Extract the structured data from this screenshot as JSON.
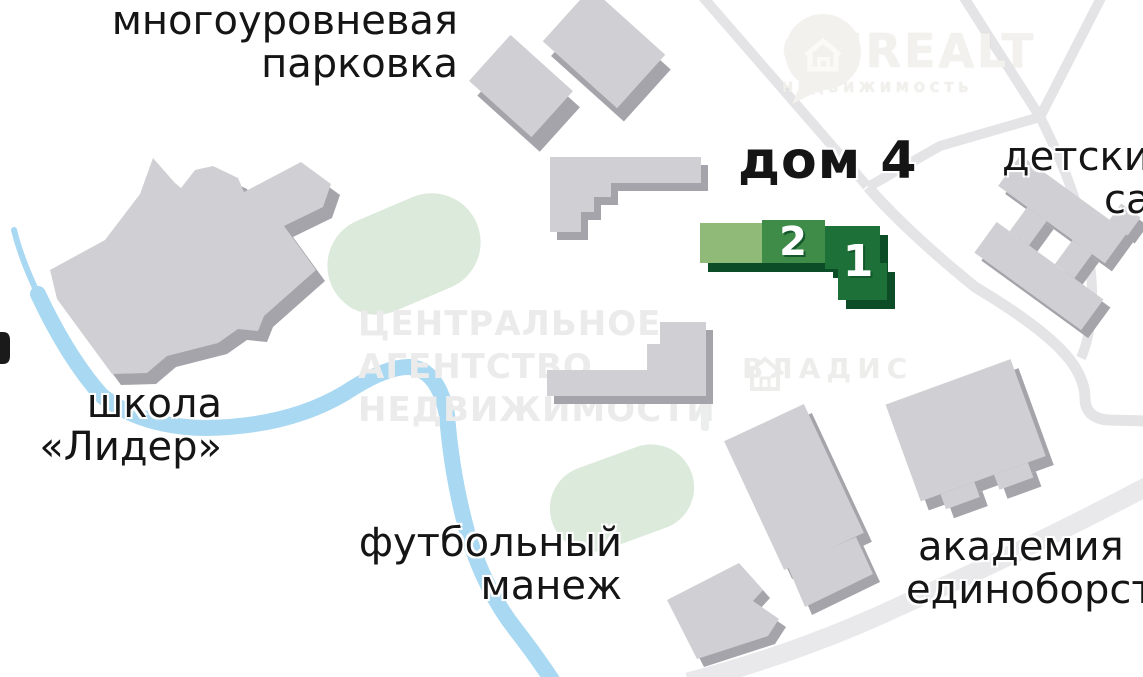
{
  "map": {
    "labels": {
      "parking_line1": "многоуровневая",
      "parking_line2": "парковка",
      "dom4": "дом 4",
      "kindergarten_line1": "детский",
      "kindergarten_line2": "сад",
      "school_line1": "школа",
      "school_line2": "«Лидер»",
      "football_line1": "футбольный",
      "football_line2": "манеж",
      "academy_line1": "академия",
      "academy_line2": "единоборств"
    },
    "house_numbers": {
      "block1": "1",
      "block2": "2"
    },
    "watermarks": {
      "onrealt_title": "ONREALT",
      "onrealt_subtitle": "НЕДВИЖИМОСТЬ",
      "agency_line1": "ЦЕНТРАЛЬНОЕ",
      "agency_line2": "АГЕНТСТВО",
      "agency_line3": "НЕДВИЖИМОСТИ",
      "vladis": "ВЛАДИС"
    },
    "colors": {
      "background": "#ffffff",
      "river": "#a8d8f2",
      "park_green": "#dceadb",
      "road": "#e4e4e7",
      "road_wide": "#e9e9eb",
      "building_gray": "#d0d0d4",
      "building_shadow": "#a4a4aa",
      "house_light_green": "#8fba77",
      "house_mid_green": "#3f8c49",
      "house_dark_green": "#1c7038",
      "house_shadow_green": "#0c4d27",
      "label_black": "#151515",
      "watermark_gray": "#ebebeb"
    }
  }
}
